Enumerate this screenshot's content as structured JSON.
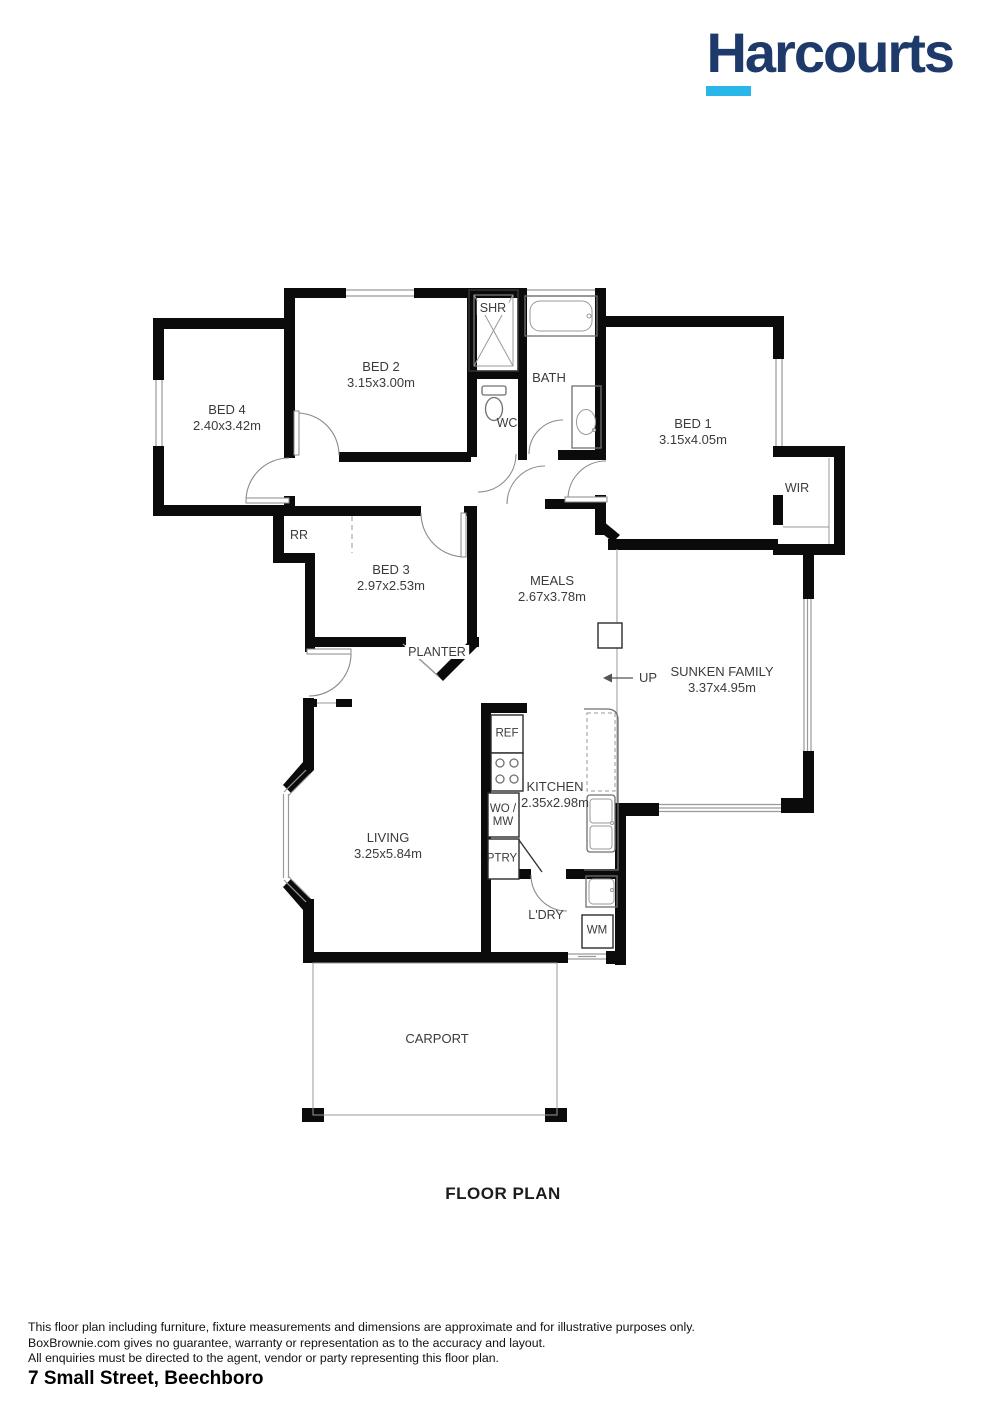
{
  "logo": {
    "text": "Harcourts",
    "navy": "#1d3a6b",
    "cyan": "#29b7ea"
  },
  "title": "FLOOR PLAN",
  "plan": {
    "rooms": {
      "bed1": {
        "label": "BED 1",
        "dims": "3.15x4.05m"
      },
      "bed2": {
        "label": "BED 2",
        "dims": "3.15x3.00m"
      },
      "bed3": {
        "label": "BED 3",
        "dims": "2.97x2.53m"
      },
      "bed4": {
        "label": "BED 4",
        "dims": "2.40x3.42m"
      },
      "meals": {
        "label": "MEALS",
        "dims": "2.67x3.78m"
      },
      "family": {
        "label": "SUNKEN FAMILY",
        "dims": "3.37x4.95m"
      },
      "kitchen": {
        "label": "KITCHEN",
        "dims": "2.35x2.98m"
      },
      "living": {
        "label": "LIVING",
        "dims": "3.25x5.84m"
      },
      "laundry": {
        "label": "L'DRY"
      },
      "carport": {
        "label": "CARPORT"
      }
    },
    "features": {
      "shr": "SHR",
      "bath": "BATH",
      "wc": "WC",
      "wir": "WIR",
      "rr": "RR",
      "planter": "PLANTER",
      "up": "UP",
      "ref": "REF",
      "wo_mw_1": "WO /",
      "wo_mw_2": "MW",
      "ptry": "PTRY",
      "wm": "WM"
    }
  },
  "footer": {
    "disclaimer": [
      "This floor plan including furniture, fixture measurements and dimensions are approximate and for illustrative purposes only.",
      "BoxBrownie.com gives no guarantee, warranty or representation as to the accuracy and layout.",
      "All enquiries must be directed to the agent, vendor or party representing this floor plan."
    ],
    "address": "7 Small Street, Beechboro"
  }
}
